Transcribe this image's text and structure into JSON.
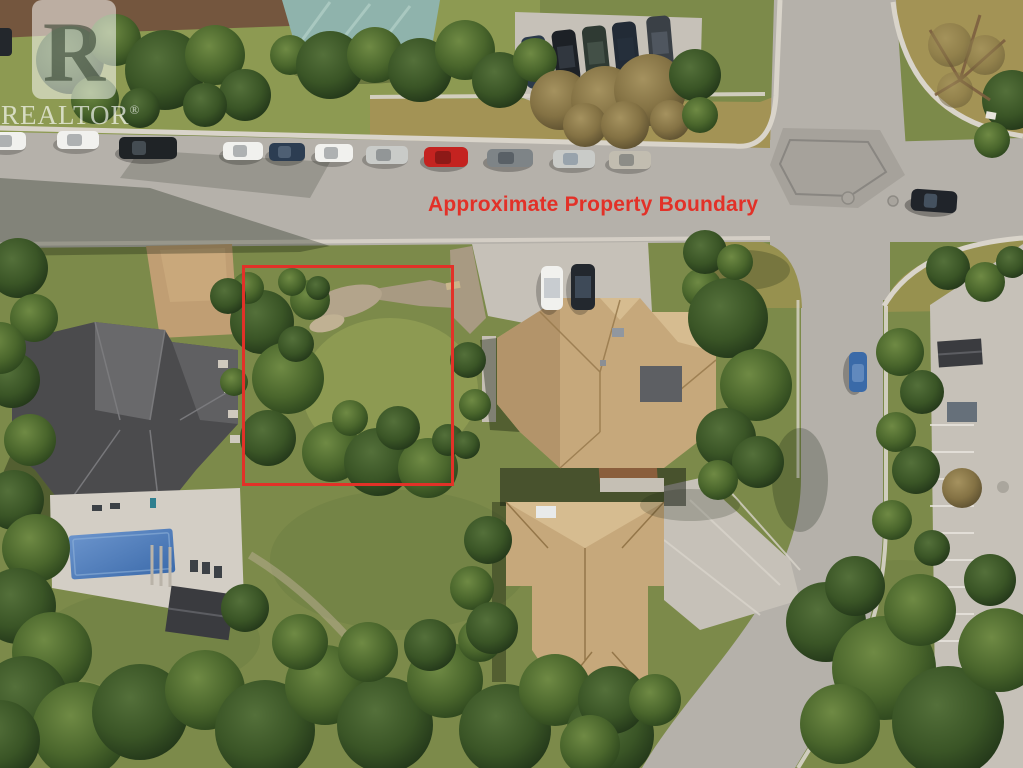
{
  "watermark": {
    "logo_letter": "R",
    "brand": "REALTOR",
    "registered_mark": "®"
  },
  "annotation": {
    "label": "Approximate Property Boundary",
    "color": "#e23128",
    "boundary_box_px": {
      "left": 242,
      "top": 265,
      "width": 212,
      "height": 221
    }
  },
  "palette": {
    "road": "#b5b1aa",
    "roadPatch": "#a6a29b",
    "sidewalk": "#d9d4ca",
    "concrete": "#c6c1b8",
    "concreteBright": "#d3cec5",
    "drygrass": "#a39355",
    "drylawn": "#97914f",
    "lawn": "#7c8a4a",
    "lawnBright": "#8d9a52",
    "lawnDark": "#68773e",
    "mulch": "#74563e",
    "gravel": "#a89a82",
    "dirtTan": "#c09e73",
    "roofTan": "#c6a87b",
    "roofTanLight": "#d6bc90",
    "roofTanShade": "#b3946a",
    "roofDark": "#4b4b4d",
    "roofDarkLight": "#6e6e71",
    "roofGreen": "#8fb3ac",
    "roofGreenLight": "#a9c8c0",
    "shedDark": "#3a3b3f",
    "deck": "#8a5e3c",
    "pool1": "#6b94cc",
    "pool2": "#3c6bab",
    "shadow": "rgba(15,25,10,0.38)",
    "treeDarkA": "#54703a",
    "treeDarkB": "#3a5526",
    "treeDarkC": "#223619",
    "treeMidA": "#6f8a44",
    "treeMidB": "#4a662c",
    "treeMidC": "#2c451d",
    "treeTanA": "#a5925f",
    "treeTanB": "#847244",
    "treeTanC": "#5d5030",
    "carWhite": "#f1f1ee",
    "carSilver": "#c9cbc8",
    "carBlack": "#1f2326",
    "carNavy": "#2c3d52",
    "carRed": "#c42320",
    "carGray": "#7e8487",
    "carBlue": "#3a6aa8",
    "carDark": "#23282e"
  }
}
